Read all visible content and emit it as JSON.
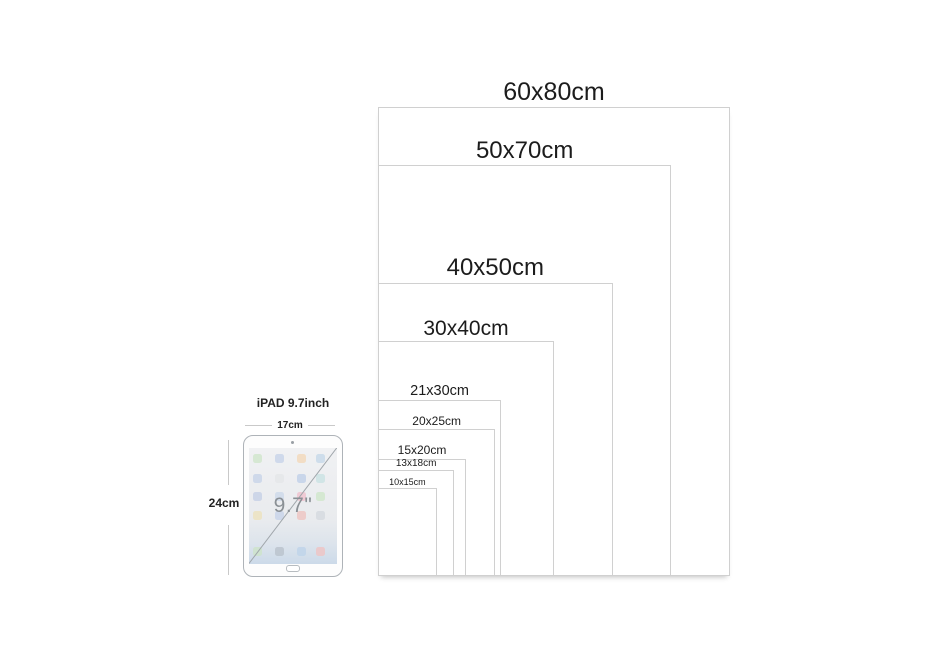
{
  "diagram": {
    "description_visible_text_only": true,
    "sizes": [
      {
        "label": "60x80cm",
        "width_cm": 60,
        "height_cm": 80
      },
      {
        "label": "50x70cm",
        "width_cm": 50,
        "height_cm": 70
      },
      {
        "label": "40x50cm",
        "width_cm": 40,
        "height_cm": 50
      },
      {
        "label": "30x40cm",
        "width_cm": 30,
        "height_cm": 40
      },
      {
        "label": "21x30cm",
        "width_cm": 21,
        "height_cm": 30
      },
      {
        "label": "20x25cm",
        "width_cm": 20,
        "height_cm": 25
      },
      {
        "label": "15x20cm",
        "width_cm": 15,
        "height_cm": 20
      },
      {
        "label": "13x18cm",
        "width_cm": 13,
        "height_cm": 18
      },
      {
        "label": "10x15cm",
        "width_cm": 10,
        "height_cm": 15
      }
    ]
  },
  "ipad": {
    "title": "iPAD 9.7inch",
    "width_label": "17cm",
    "height_label": "24cm",
    "screen_label": "9.7\"",
    "icon_colors": [
      "#cfe6cb",
      "#c7d3e8",
      "#f2d8b9",
      "#c5d8e8",
      "#c7d3e8",
      "#e4e6e8",
      "#bfcfe8",
      "#c9e2e4",
      "#c5cfe6",
      "#cdd8ea",
      "#f0c0cd",
      "#cfe6cb",
      "#ece2bd",
      "#c7d3e8",
      "#eec4c0",
      "#d5dadf",
      "#cde4c9",
      "#b9c2cc",
      "#bed3ea",
      "#efc3c3"
    ]
  },
  "colors": {
    "background": "#ffffff",
    "frame_border": "#d0d0d0",
    "label_text": "#1c1c1c",
    "ipad_border": "#aeb3b8",
    "dim_line": "#c9c9c9",
    "screen_text": "#8a9095"
  }
}
